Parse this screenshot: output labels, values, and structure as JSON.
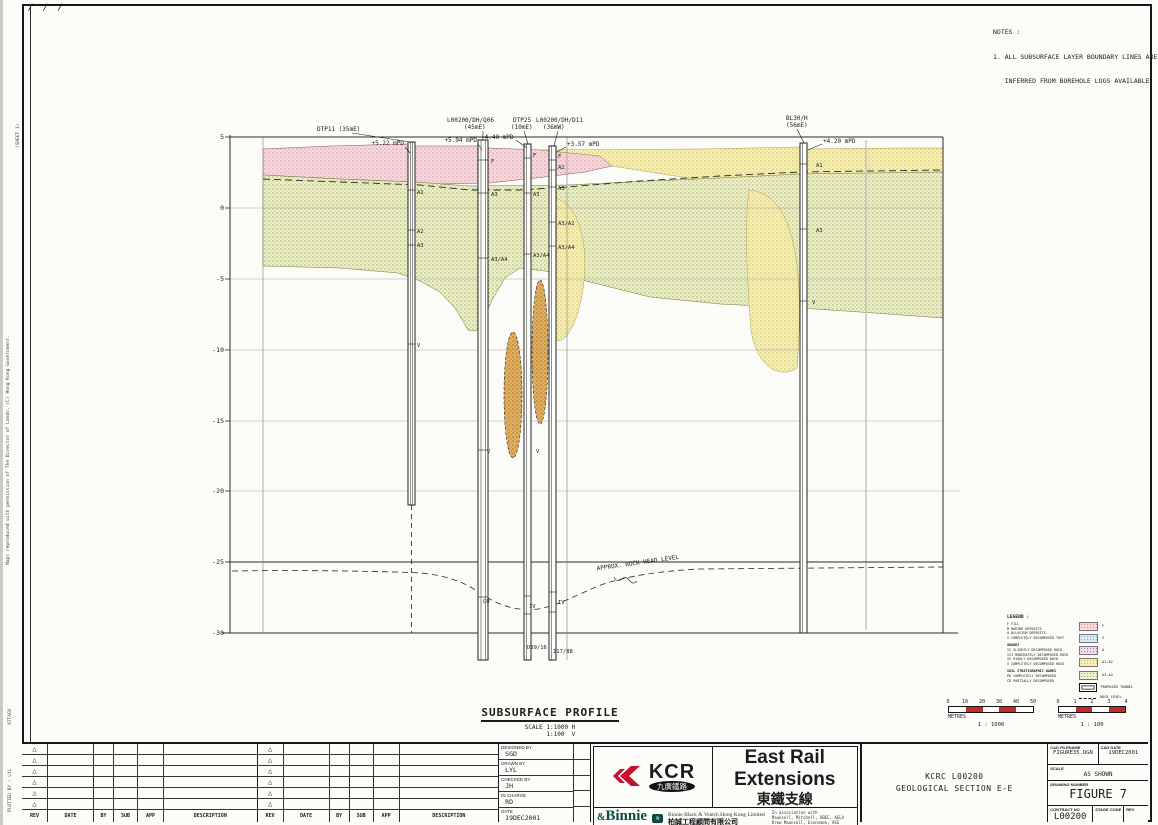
{
  "margin": {
    "slashes": "/ / /",
    "top_text": "(SHEET 1)",
    "mid_text": "Maps reproduced with permission of The Director of Lands. (C) Hong Kong Government.",
    "bottom_text1": "ATTACH",
    "bottom_text2": "PLOTTED BY : LYL"
  },
  "notes": {
    "title": "NOTES :",
    "line1": "1. ALL SUBSURFACE LAYER BOUNDARY LINES ARE",
    "line2": "   INFERRED FROM BOREHOLE LOGS AVAILABLE."
  },
  "section": {
    "title": "SUBSURFACE PROFILE",
    "scale_line1": "SCALE 1:1000 H",
    "scale_line2": "      1:100  V",
    "yticks": [
      "5",
      "0",
      "-5",
      "-10",
      "-15",
      "-20",
      "-25",
      "-30"
    ],
    "rockhead": "APPROX. ROCK HEAD LEVEL",
    "bh": {
      "bh1": {
        "name": "DTP11 (35mE)",
        "lvl": "+5.22 mPD"
      },
      "bh2": {
        "name": "L00200/DH/Q06",
        "sub": "(45mE)",
        "lvl": "+5.94 mPD"
      },
      "bh3": {
        "name": "DTP25",
        "sub": "(10mE)",
        "lvl": "+4.40 mPD"
      },
      "bh4": {
        "name": "L00200/DH/D11",
        "sub": "(36mW)",
        "lvl": "+3.57 mPD"
      },
      "bh5": {
        "name": "BL30/H",
        "sub": "(56mE)",
        "lvl": "+4.20 mPD"
      }
    },
    "strata": [
      "A1",
      "A2",
      "A3",
      "V",
      "F",
      "A3",
      "A3/A4",
      "V",
      "C0",
      "D89/16",
      "F",
      "A3",
      "A3/A4",
      "IV",
      "F",
      "A2",
      "A3",
      "A3/A2",
      "A3/A4",
      "IV",
      "117/88",
      "A1",
      "A3",
      "V",
      "V"
    ]
  },
  "legend": {
    "title": "LEGEND :",
    "text_lines": [
      "F   FILL",
      "M   MARINE DEPOSITS",
      "A   ALLUVIUM DEPOSITS",
      "V   COMPLETELY DECOMPOSED TUFF",
      "GRADES",
      "II   SLIGHTLY DECOMPOSED ROCK",
      "III  MODERATELY DECOMPOSED ROCK",
      "IV   HIGHLY DECOMPOSED ROCK",
      "V    COMPLETELY DECOMPOSED ROCK",
      "SOIL STRATIGRAPHIC NAMES",
      "PD   COMPLETELY DECOMPOSED",
      "CD   PARTIALLY DECOMPOSED"
    ],
    "swatches": [
      {
        "label": "F"
      },
      {
        "label": "V"
      },
      {
        "label": "A"
      },
      {
        "label": "A1,A2"
      },
      {
        "label": "A3,A4"
      },
      {
        "label": "PROPOSED TUNNEL"
      },
      {
        "label": "ROCK LEVEL"
      }
    ]
  },
  "scalebar1": {
    "ticks": [
      "0",
      "10",
      "20",
      "30",
      "40",
      "50"
    ],
    "unit": "METRES",
    "ratio": "1 : 1000"
  },
  "scalebar2": {
    "ticks": [
      "0",
      "1",
      "2",
      "3",
      "4"
    ],
    "unit": "METRES",
    "ratio": "1 : 100"
  },
  "revtable": {
    "triangle": "△",
    "headers": [
      "REV",
      "DATE",
      "BY",
      "SUB",
      "APP",
      "DESCRIPTION"
    ]
  },
  "credits": {
    "rows": [
      {
        "label": "DESIGNED BY",
        "value": "SGD"
      },
      {
        "label": "DRAWN BY",
        "value": "LYL"
      },
      {
        "label": "CHECKED BY",
        "value": "JH"
      },
      {
        "label": "IN CHARGE",
        "value": "RD"
      },
      {
        "label": "DATE",
        "value": "19DEC2001"
      }
    ]
  },
  "kcr": {
    "word": "KCR",
    "oval_zh": "九廣鐵路",
    "title_en": "East Rail Extensions",
    "title_zh": "東鐵支線",
    "consultant": "Binnie",
    "consultant_amp": "&",
    "consultant_full": "Binnie Black & Veatch Hong Kong Limited",
    "consultant_zh": "柏誠工程顧問有限公司",
    "assoc1": "In association with",
    "assoc2": "Maunsell, Mitchell, DBEC, AELA",
    "assoc3": "Drew Maunsell, Economee, ASG"
  },
  "project": {
    "line1": "KCRC L00200",
    "line2": "GEOLOGICAL SECTION E-E"
  },
  "docinfo": {
    "cad_filename_label": "CAD FILENAME",
    "cad_filename": "FIGURE35.DGN",
    "cad_date_label": "CAD DATE",
    "cad_date": "19DEC2001",
    "scale_label": "SCALE",
    "scale": "AS SHOWN",
    "drawing_number_label": "DRAWING NUMBER",
    "drawing_number": "FIGURE 7",
    "contract_label": "CONTRACT NO",
    "contract": "L00200",
    "stage_label": "STAGE CODE",
    "rev_label": "REV"
  }
}
